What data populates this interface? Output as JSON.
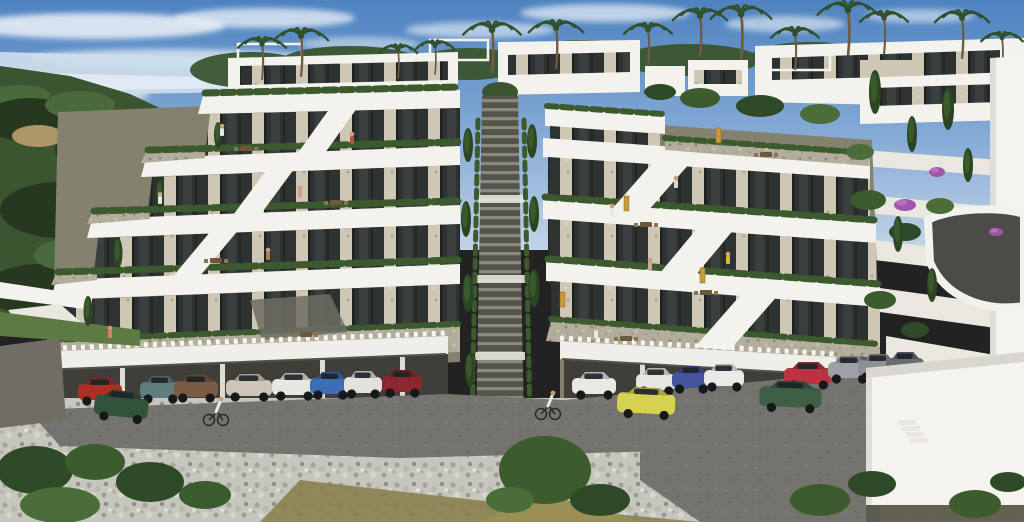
{
  "scene": {
    "type": "architectural-render",
    "alt": "Photorealistic render of a terraced hillside apartment complex with white fascia bands, stone-clad pillars, glass facades, roof gardens, a central outdoor staircase, palm trees, Mediterranean forest to the left, covered parking with cars and two cyclists below, and white retaining walls with a curved driveway to the right."
  },
  "palette": {
    "skyTop": "#4e82c0",
    "skyMid": "#86abd6",
    "skyLow": "#c3d4e6",
    "cloud": "#eef3f8",
    "sea": "#cfdeeb",
    "band": "#f3f2ec",
    "white2": "#e9e7e0",
    "canopy": "#efeee8",
    "wall": "#84826f",
    "walldk": "#6f6d64",
    "opening": "#3f3e39",
    "hedge": "#3d5a2f",
    "forest": "#3a5530",
    "forestDk": "#26381f",
    "forestLt": "#4a6a3c",
    "lawn": "#5d7a42",
    "clearing": "#ad9668",
    "stone": "#cfc7b5",
    "glass": "#2e3331",
    "pebbleBase": "#c6c5be",
    "asphalt": "#74736e",
    "dirt": "#8a8150",
    "olive": "#9a8f55",
    "rtwall": "#f4f3ef",
    "drive": "#4b4b47",
    "trunk": "#6e5b40",
    "skin": "#caa07b",
    "wheel": "#17181a"
  },
  "clouds": [
    [
      95,
      26,
      130,
      13,
      0.85
    ],
    [
      265,
      18,
      90,
      10,
      0.75
    ],
    [
      480,
      30,
      75,
      8,
      0.6
    ],
    [
      605,
      13,
      85,
      9,
      0.7
    ],
    [
      785,
      24,
      60,
      8,
      0.6
    ],
    [
      170,
      58,
      140,
      9,
      0.7
    ],
    [
      60,
      95,
      90,
      8,
      0.8
    ],
    [
      920,
      16,
      55,
      7,
      0.55
    ],
    [
      360,
      44,
      60,
      7,
      0.5
    ]
  ],
  "palms": [
    [
      262,
      44,
      15
    ],
    [
      301,
      36,
      17
    ],
    [
      398,
      50,
      12
    ],
    [
      435,
      46,
      12
    ],
    [
      492,
      30,
      18
    ],
    [
      556,
      28,
      17
    ],
    [
      648,
      30,
      15
    ],
    [
      700,
      16,
      17
    ],
    [
      741,
      14,
      19
    ],
    [
      795,
      34,
      15
    ],
    [
      848,
      10,
      19
    ],
    [
      884,
      18,
      15
    ],
    [
      962,
      18,
      17
    ],
    [
      1002,
      38,
      13
    ]
  ],
  "cypresses": [
    [
      468,
      162,
      10,
      34
    ],
    [
      532,
      158,
      10,
      34
    ],
    [
      466,
      237,
      10,
      36
    ],
    [
      534,
      232,
      10,
      36
    ],
    [
      468,
      312,
      11,
      38
    ],
    [
      534,
      307,
      11,
      38
    ],
    [
      470,
      387,
      10,
      34
    ],
    [
      218,
      148,
      8,
      26
    ],
    [
      160,
      208,
      8,
      28
    ],
    [
      118,
      268,
      9,
      30
    ],
    [
      88,
      326,
      9,
      30
    ],
    [
      875,
      114,
      12,
      44
    ],
    [
      912,
      152,
      10,
      36
    ],
    [
      948,
      130,
      12,
      42
    ],
    [
      968,
      182,
      10,
      34
    ],
    [
      898,
      252,
      10,
      36
    ],
    [
      932,
      302,
      10,
      34
    ]
  ],
  "bushes": [
    [
      868,
      200,
      18,
      10,
      1
    ],
    [
      905,
      232,
      16,
      9,
      0
    ],
    [
      940,
      206,
      14,
      8,
      2
    ],
    [
      880,
      300,
      16,
      9,
      1
    ],
    [
      915,
      330,
      14,
      8,
      0
    ],
    [
      860,
      152,
      14,
      8,
      2
    ],
    [
      700,
      98,
      20,
      10,
      1
    ],
    [
      760,
      106,
      24,
      11,
      0
    ],
    [
      820,
      114,
      20,
      10,
      2
    ],
    [
      660,
      92,
      16,
      8,
      0
    ],
    [
      35,
      470,
      38,
      24,
      0
    ],
    [
      95,
      462,
      30,
      18,
      1
    ],
    [
      150,
      482,
      34,
      20,
      0
    ],
    [
      60,
      505,
      40,
      18,
      2
    ],
    [
      205,
      495,
      26,
      14,
      1
    ],
    [
      545,
      470,
      46,
      34,
      1
    ],
    [
      600,
      500,
      30,
      16,
      0
    ],
    [
      510,
      500,
      24,
      13,
      2
    ],
    [
      820,
      500,
      30,
      16,
      1
    ],
    [
      872,
      484,
      24,
      13,
      0
    ],
    [
      975,
      504,
      26,
      14,
      1
    ],
    [
      1008,
      482,
      18,
      10,
      0
    ]
  ],
  "purples": [
    [
      905,
      205,
      11,
      6
    ],
    [
      937,
      172,
      8,
      5
    ],
    [
      996,
      232,
      7,
      4
    ]
  ],
  "people": [
    [
      222,
      128,
      "#e8e8e6"
    ],
    [
      352,
      136,
      "#c05040"
    ],
    [
      160,
      196,
      "#e8e8e6"
    ],
    [
      300,
      190,
      "#c9a08a"
    ],
    [
      268,
      252,
      "#b08050"
    ],
    [
      728,
      256,
      "#d8b93a"
    ],
    [
      612,
      208,
      "#e8e8e6"
    ],
    [
      650,
      262,
      "#c8a8a0"
    ],
    [
      110,
      330,
      "#d88070"
    ],
    [
      596,
      330,
      "#e8e8e6"
    ],
    [
      676,
      180,
      "#e0d8c8"
    ]
  ],
  "tables": [
    [
      240,
      146
    ],
    [
      330,
      200
    ],
    [
      210,
      258
    ],
    [
      640,
      222
    ],
    [
      700,
      290
    ],
    [
      300,
      332
    ],
    [
      620,
      336
    ],
    [
      760,
      152
    ]
  ],
  "amber_doors": [
    [
      624,
      196
    ],
    [
      700,
      268
    ],
    [
      560,
      292
    ],
    [
      716,
      128
    ]
  ],
  "cars": [
    {
      "x": 78,
      "y": 378,
      "w": 44,
      "color": "#ab2f26"
    },
    {
      "x": 140,
      "y": 376,
      "w": 40,
      "color": "#5f7f7e"
    },
    {
      "x": 174,
      "y": 375,
      "w": 44,
      "color": "#7b5b44"
    },
    {
      "x": 226,
      "y": 374,
      "w": 46,
      "color": "#cdc6b8"
    },
    {
      "x": 272,
      "y": 373,
      "w": 44,
      "color": "#e6e6e2"
    },
    {
      "x": 310,
      "y": 372,
      "w": 40,
      "color": "#3e6db3"
    },
    {
      "x": 344,
      "y": 371,
      "w": 38,
      "color": "#e2e1dc"
    },
    {
      "x": 382,
      "y": 370,
      "w": 40,
      "color": "#8c2630"
    },
    {
      "x": 96,
      "y": 388,
      "w": 54,
      "h": 24,
      "rot": 6,
      "color": "#33523a"
    },
    {
      "x": 572,
      "y": 372,
      "w": 44,
      "color": "#e8e8e4"
    },
    {
      "x": 636,
      "y": 368,
      "w": 40,
      "color": "#e6e6e2"
    },
    {
      "x": 672,
      "y": 366,
      "w": 38,
      "color": "#44549e"
    },
    {
      "x": 704,
      "y": 364,
      "w": 40,
      "color": "#eceae6"
    },
    {
      "x": 784,
      "y": 362,
      "w": 48,
      "color": "#bb3340"
    },
    {
      "x": 828,
      "y": 356,
      "w": 42,
      "color": "#9da1a4"
    },
    {
      "x": 858,
      "y": 354,
      "w": 40,
      "color": "#8d9194"
    },
    {
      "x": 886,
      "y": 352,
      "w": 38,
      "color": "#6a6e72"
    },
    {
      "x": 618,
      "y": 386,
      "w": 58,
      "h": 24,
      "rot": 3,
      "color": "#d6d24f"
    },
    {
      "x": 760,
      "y": 380,
      "w": 62,
      "h": 24,
      "rot": 2,
      "color": "#3e5f46"
    }
  ],
  "cyclists": [
    [
      216,
      404
    ],
    [
      548,
      398
    ]
  ]
}
